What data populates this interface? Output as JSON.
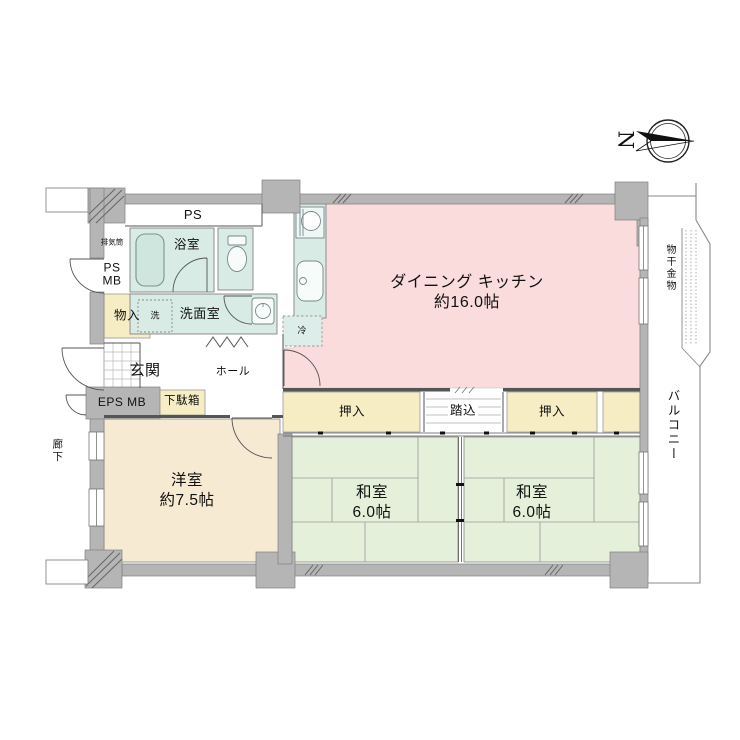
{
  "compass": {
    "north": "N"
  },
  "rooms": {
    "dining_kitchen": {
      "name": "ダイニング キッチン",
      "size": "約16.0帖"
    },
    "western_room": {
      "name": "洋室",
      "size": "約7.5帖"
    },
    "japanese_room_1": {
      "name": "和室",
      "size": "6.0帖"
    },
    "japanese_room_2": {
      "name": "和室",
      "size": "6.0帖"
    },
    "bathroom": "浴室",
    "washroom": "洗面室",
    "entrance": "玄関",
    "hall": "ホール"
  },
  "storage": {
    "closet_1": "押入",
    "closet_2": "押入",
    "step_in": "踏込",
    "storage_closet": "物入",
    "shoe_cabinet": "下駄箱"
  },
  "utilities": {
    "pipe_space": "PS",
    "ps_mb": {
      "line1": "PS",
      "line2": "MB"
    },
    "eps_mb": "EPS MB",
    "exhaust_duct": "排気筒",
    "washer": "洗",
    "refrigerator": "冷"
  },
  "exterior": {
    "balcony": "バルコニー",
    "laundry_hanger": "物干金物",
    "corridor": "廊下"
  },
  "colors": {
    "dining_kitchen": "#fadcdc",
    "tatami_room": "#e4f0da",
    "western_room": "#f7ead2",
    "closet": "#f6edc4",
    "wet_area": "#d8ebe5",
    "wall": "#b5b5b5"
  }
}
